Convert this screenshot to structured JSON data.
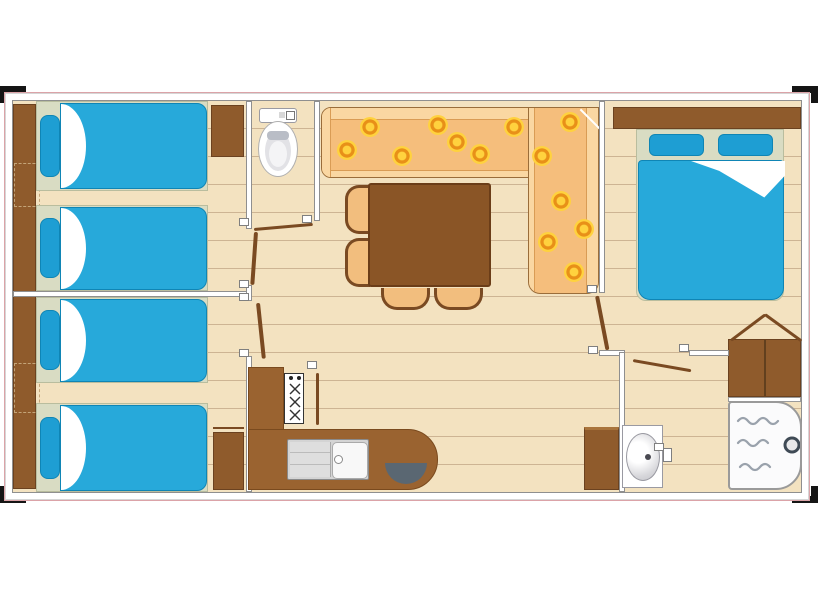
{
  "description": "Top-view floor plan of a mobile home with three bedrooms, living-dining area, kitchen, WC and shower room",
  "plan": {
    "rooms": [
      {
        "name": "bedroom-twin-front",
        "furniture": [
          "wardrobe-strip",
          "single-bed",
          "single-bed",
          "bedside-wardrobe"
        ]
      },
      {
        "name": "bedroom-twin-rear",
        "furniture": [
          "wardrobe-strip",
          "single-bed",
          "single-bed",
          "bedside-wardrobe"
        ]
      },
      {
        "name": "wc-room",
        "furniture": [
          "toilet"
        ]
      },
      {
        "name": "hallway",
        "furniture": []
      },
      {
        "name": "living-dining",
        "furniture": [
          "corner-sofa",
          "dining-table",
          "chair",
          "chair",
          "chair",
          "chair",
          "cabinet"
        ]
      },
      {
        "name": "kitchen",
        "furniture": [
          "counter",
          "hob",
          "sink",
          "round-basin"
        ]
      },
      {
        "name": "bedroom-double",
        "furniture": [
          "headboard",
          "double-bed",
          "wardrobe"
        ]
      },
      {
        "name": "shower-room",
        "furniture": [
          "shower",
          "washbasin"
        ]
      }
    ],
    "counts": {
      "single_beds": 4,
      "double_beds": 1,
      "door_leaves": 6,
      "chairs": 4,
      "sunflowers": 13,
      "corner_marks": 4
    }
  },
  "colors": {
    "floor": "#F3E2C0",
    "plank_line": "#CDB493",
    "wall_fill": "#FFFFFF",
    "wall_line": "#8F8F8F",
    "frame_pink": "#DBA3A8",
    "corner_mark": "#151515",
    "bed_duvet": "#27A9DA",
    "bed_pillow": "#1E9ED3",
    "mattress": "#D9DCC3",
    "wood_dark": "#6B4220",
    "wood": "#8F5B2C",
    "counter": "#9A6330",
    "table": "#8A5526",
    "chair_fill": "#F2BE7E",
    "chair_line": "#7A4A22",
    "sofa_seat": "#F5BE7C",
    "sofa_trim": "#FAD7A2",
    "flower_yellow": "#FFD23E",
    "flower_ring": "#E89018",
    "fixture_dark": "#5A6772",
    "door_leaf": "#7A4A22"
  },
  "decor": {
    "flowers": [
      [
        334,
        49
      ],
      [
        357,
        26
      ],
      [
        389,
        55
      ],
      [
        425,
        24
      ],
      [
        444,
        41
      ],
      [
        467,
        53
      ],
      [
        501,
        26
      ],
      [
        529,
        55
      ],
      [
        557,
        21
      ],
      [
        548,
        100
      ],
      [
        571,
        128
      ],
      [
        535,
        141
      ],
      [
        561,
        171
      ]
    ],
    "hinges": [
      [
        231,
        121
      ],
      [
        294,
        118
      ],
      [
        231,
        183
      ],
      [
        231,
        196
      ],
      [
        231,
        252
      ],
      [
        579,
        188
      ],
      [
        580,
        249
      ],
      [
        671,
        247
      ],
      [
        646,
        346
      ],
      [
        299,
        264
      ]
    ]
  }
}
